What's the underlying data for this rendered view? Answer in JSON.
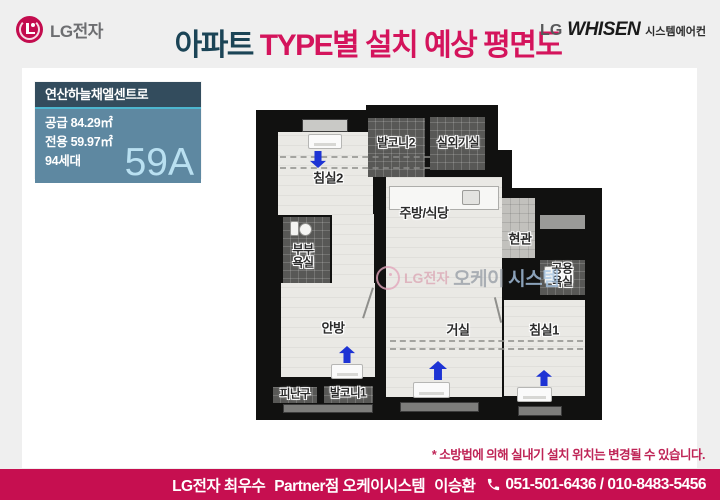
{
  "header": {
    "lg_logo_text": "LG전자",
    "title": {
      "part1": "아파트",
      "part2": " TYPE별 설치 예상 평면도"
    },
    "whisen": {
      "lg": "LG",
      "brand": "WHISEN",
      "sub": "시스템에어컨"
    }
  },
  "info_box": {
    "complex_name": "연산하늘채엘센트로",
    "supply_area": "공급 84.29㎡",
    "exclusive_area": "전용 59.97㎡",
    "households": "94세대",
    "type_code": "59A"
  },
  "plan": {
    "rooms": [
      {
        "id": "bedroom2",
        "label": "침실2",
        "ac_unit": true,
        "airflow_arrow": "down"
      },
      {
        "id": "balcony2",
        "label": "발코니2",
        "ac_unit": false,
        "airflow_arrow": null
      },
      {
        "id": "outdoor-unit",
        "label": "실외기실",
        "ac_unit": false,
        "airflow_arrow": null
      },
      {
        "id": "kitchen-dining",
        "label": "주방/식당",
        "ac_unit": false,
        "airflow_arrow": null
      },
      {
        "id": "entrance",
        "label": "현관",
        "ac_unit": false,
        "airflow_arrow": null
      },
      {
        "id": "shared-bathroom",
        "label": "공용\n욕실",
        "ac_unit": false,
        "airflow_arrow": null
      },
      {
        "id": "master-bathroom",
        "label": "부부\n욕실",
        "ac_unit": false,
        "airflow_arrow": null
      },
      {
        "id": "master-bedroom",
        "label": "안방",
        "ac_unit": true,
        "airflow_arrow": "up"
      },
      {
        "id": "living-room",
        "label": "거실",
        "ac_unit": true,
        "airflow_arrow": "up"
      },
      {
        "id": "bedroom1",
        "label": "침실1",
        "ac_unit": true,
        "airflow_arrow": "up"
      },
      {
        "id": "evacuation-space",
        "label": "피난구",
        "ac_unit": false,
        "airflow_arrow": null
      },
      {
        "id": "balcony1",
        "label": "발코니1",
        "ac_unit": false,
        "airflow_arrow": null
      }
    ],
    "watermark": {
      "lg": "LG전자",
      "okay": "오케이",
      "system": "시스템"
    }
  },
  "disclaimer": "* 소방법에 의해 실내기 설치 위치는 변경될 수 있습니다.",
  "footer": {
    "company": "LG전자 최우수",
    "partner": "Partner점 오케이시스템",
    "person": "이승환",
    "phone_icon": "phone-icon",
    "phones": "051-501-6436 / 010-8483-5456"
  },
  "colors": {
    "accent_pink": "#d4145c",
    "title_dark": "#1b4456",
    "footer_bg": "#c60f50",
    "infobox_header_bg": "#334c5d",
    "infobox_body_bg": "#5e88a1",
    "type_code_text": "#b9e0f1",
    "arrow_blue": "#1d33d4",
    "wall_black": "#111110"
  }
}
